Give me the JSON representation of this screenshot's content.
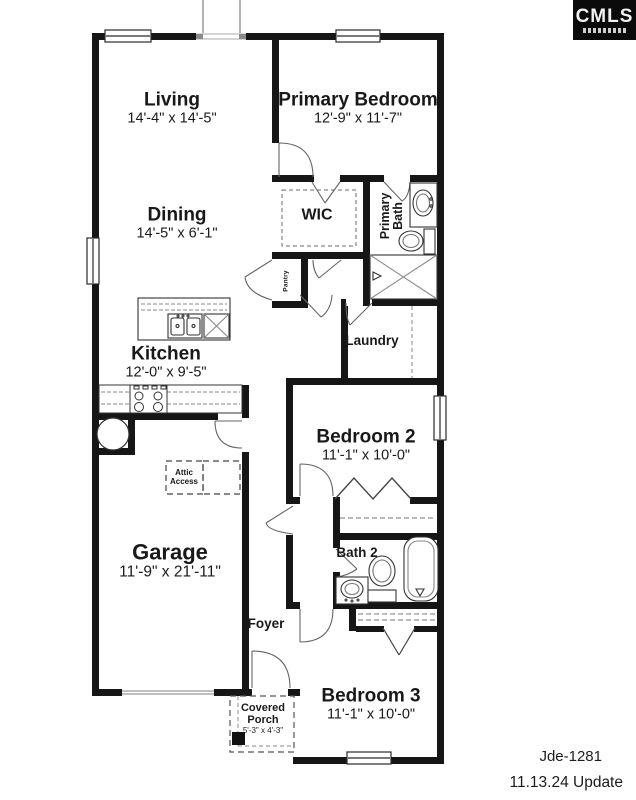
{
  "logo": {
    "text": "CMLS"
  },
  "rooms": {
    "living": {
      "name": "Living",
      "dims": "14'-4\" x 14'-5\""
    },
    "primary_bedroom": {
      "name": "Primary Bedroom",
      "dims": "12'-9\" x 11'-7\""
    },
    "dining": {
      "name": "Dining",
      "dims": "14'-5\" x 6'-1\""
    },
    "wic": {
      "name": "WIC"
    },
    "primary_bath": {
      "name": "Primary Bath"
    },
    "pantry": {
      "name": "Pantry"
    },
    "laundry": {
      "name": "Laundry"
    },
    "kitchen": {
      "name": "Kitchen",
      "dims": "12'-0\" x 9'-5\""
    },
    "bedroom2": {
      "name": "Bedroom 2",
      "dims": "11'-1\" x 10'-0\""
    },
    "garage": {
      "name": "Garage",
      "dims": "11'-9\" x 21'-11\""
    },
    "attic_access": {
      "name": "Attic Access"
    },
    "bath2": {
      "name": "Bath 2"
    },
    "foyer": {
      "name": "Foyer"
    },
    "covered_porch": {
      "name": "Covered Porch",
      "dims": "5'-3\" x 4'-3\""
    },
    "bedroom3": {
      "name": "Bedroom 3",
      "dims": "11'-1\" x 10'-0\""
    }
  },
  "footer": {
    "plan_id": "Jde-1281",
    "update_note": "11.13.24 Update"
  },
  "colors": {
    "wall": "#161616",
    "door_line": "#666666",
    "fixture_line": "#333333"
  }
}
